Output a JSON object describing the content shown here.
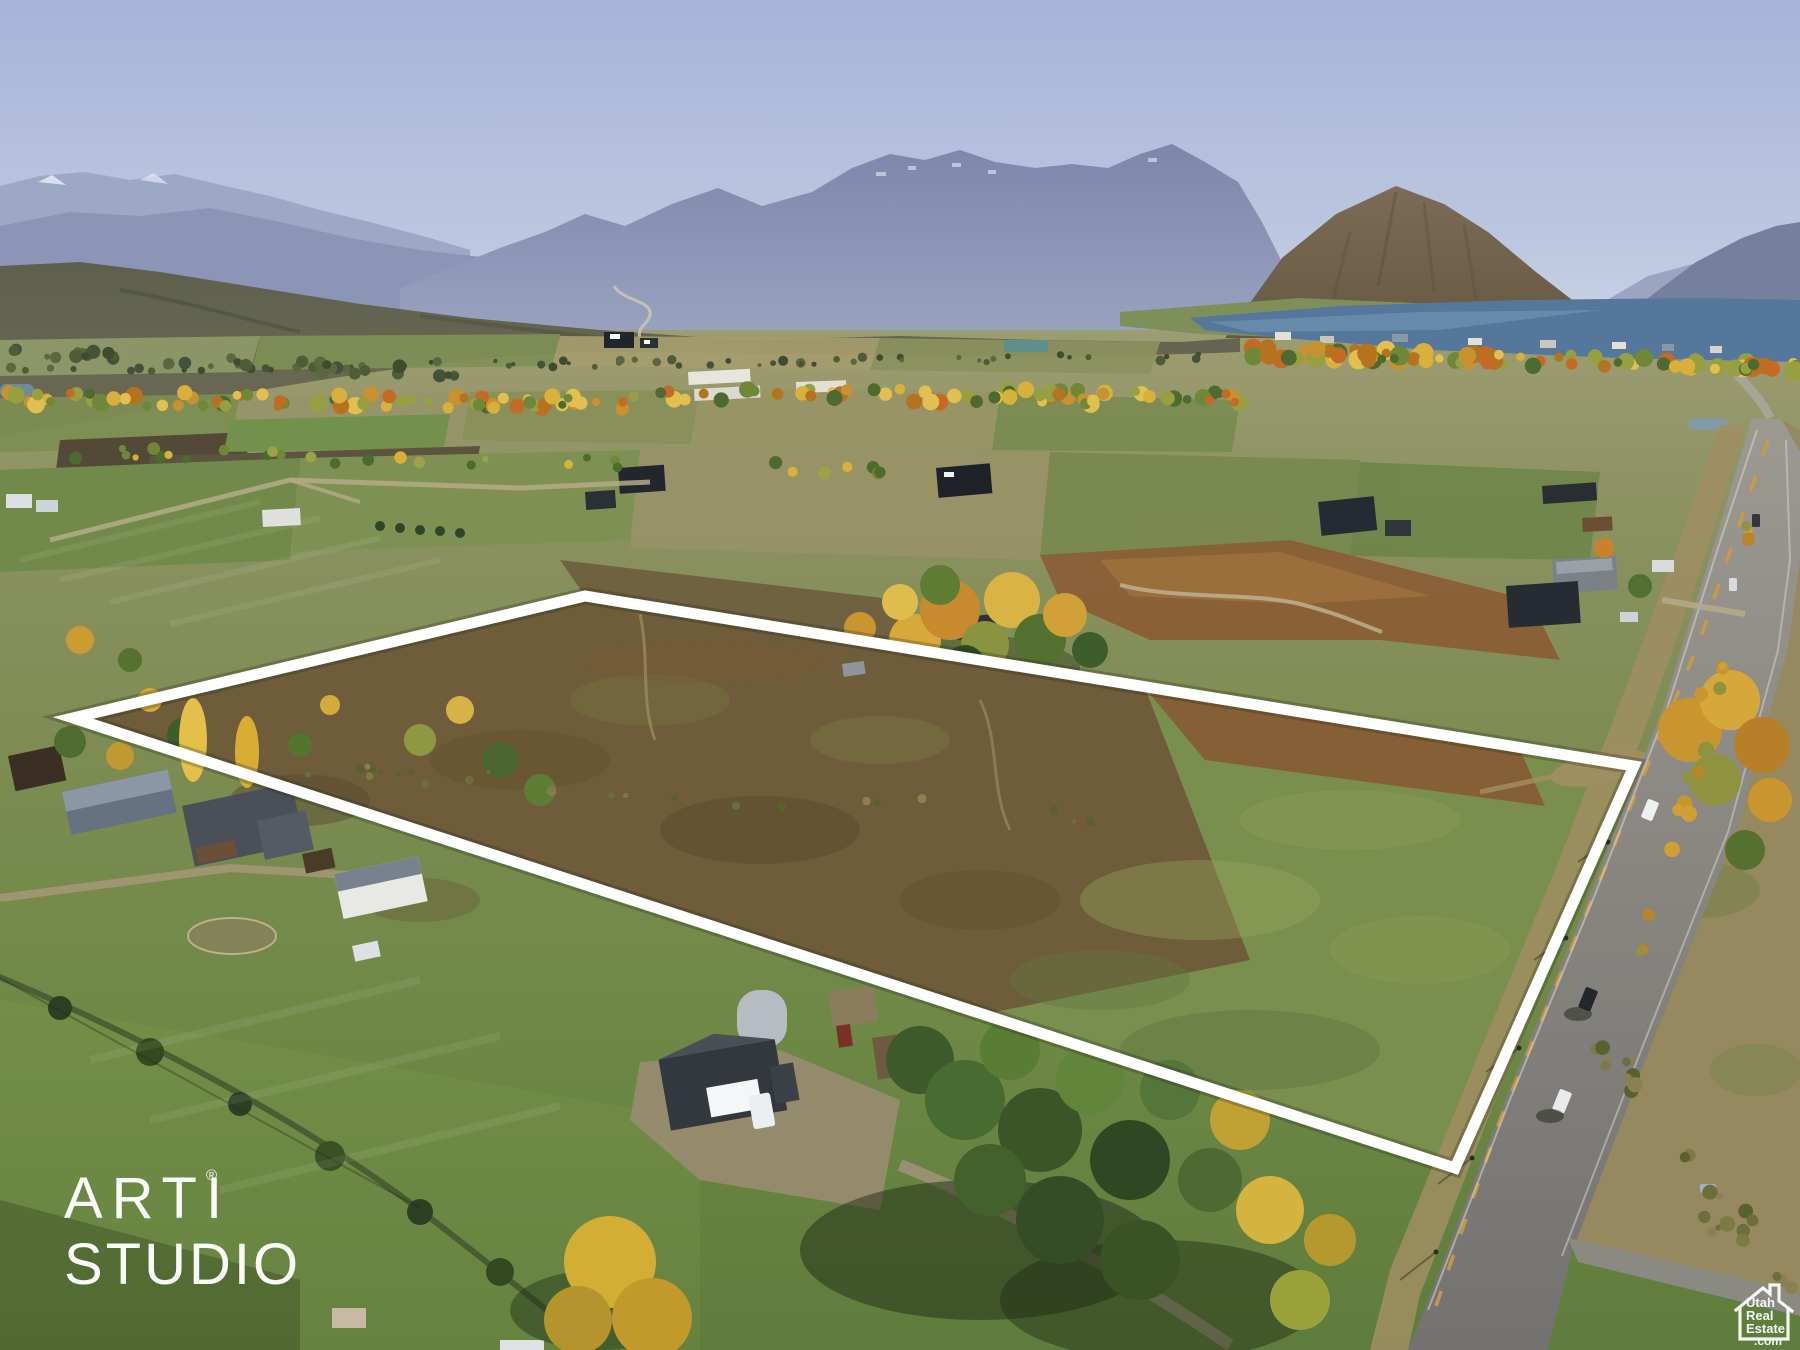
{
  "watermarks": {
    "studio": {
      "line1": "ARTI",
      "registered_mark": "®",
      "line2": "STUDIO"
    },
    "listing": {
      "word1": "Utah",
      "word2": "Real",
      "word3": "Estate",
      "word4": ".com"
    }
  },
  "scene": {
    "colors": {
      "boundary": "#ffffff",
      "sky_top": "#a7b4d8",
      "lake": "#54779b",
      "parcel_green": "#7a8e4e",
      "parcel_brown": "#6e5c3a",
      "road": "#8b8a82"
    }
  }
}
